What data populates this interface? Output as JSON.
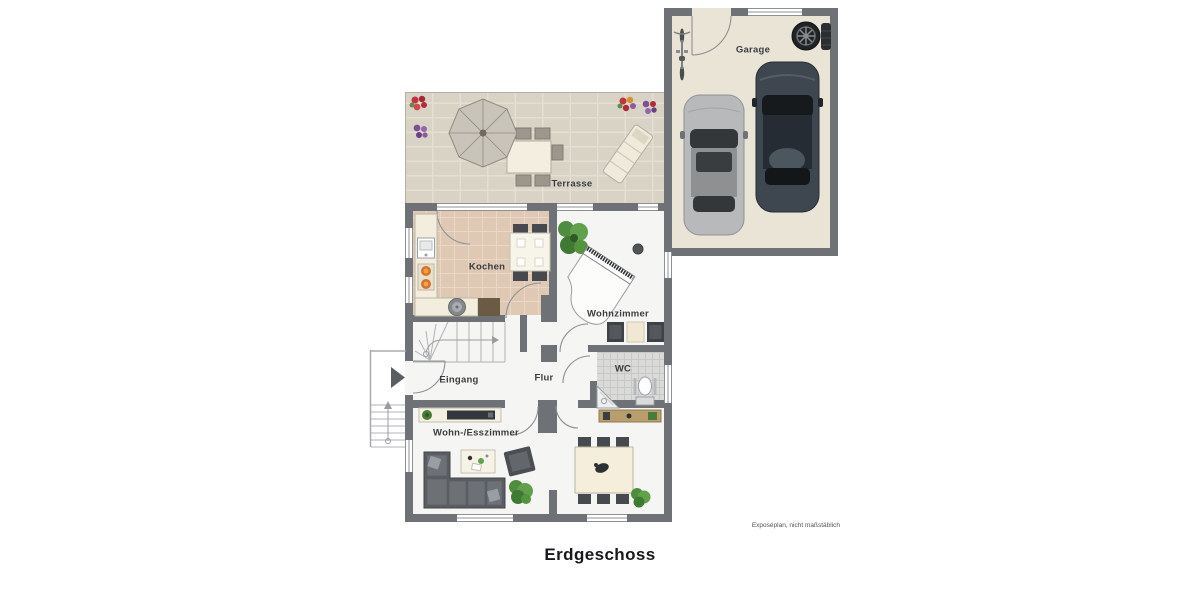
{
  "title": "Erdgeschoss",
  "footnote": "Exposéplan, nicht maßstäblich",
  "rooms": {
    "terrasse": "Terrasse",
    "garage": "Garage",
    "kochen": "Kochen",
    "wohnzimmer": "Wohnzimmer",
    "wc": "WC",
    "eingang": "Eingang",
    "flur": "Flur",
    "wohn_esszimmer": "Wohn-/Esszimmer"
  },
  "inventory": {
    "terrasse": [
      "parasol",
      "dining table with chairs",
      "sun lounger",
      "flower beds"
    ],
    "garage": [
      "silver car",
      "dark car",
      "bicycle",
      "spare wheels"
    ],
    "kochen": [
      "counter with sink and stove",
      "table with four chairs"
    ],
    "wohnzimmer": [
      "grand piano with stool",
      "potted plant",
      "two chairs with side table"
    ],
    "wc": [
      "toilet",
      "corner basin"
    ],
    "eingang": [
      "winder staircase",
      "entrance door",
      "exterior steps"
    ],
    "wohn_esszimmer": [
      "corner sofa",
      "coffee table",
      "armchair",
      "tv sideboard",
      "dining table with six chairs",
      "potted plants"
    ]
  },
  "colors": {
    "wall": "#6e7175",
    "floor": "#f5f5f3",
    "terrace": "#d9d3c6",
    "kitchen": "#e0c9b4",
    "garage": "#eae4d6",
    "wc": "#dadbd9",
    "dark": "#46494d",
    "cream": "#f2ecdb",
    "wood": "#b99e6d",
    "plant": "#55933f",
    "label": "#3a3d40",
    "accent_red": "#b5303a",
    "accent_purple": "#7d4f93",
    "car_silver": "#b7b9bb",
    "car_dark": "#3e4650"
  }
}
